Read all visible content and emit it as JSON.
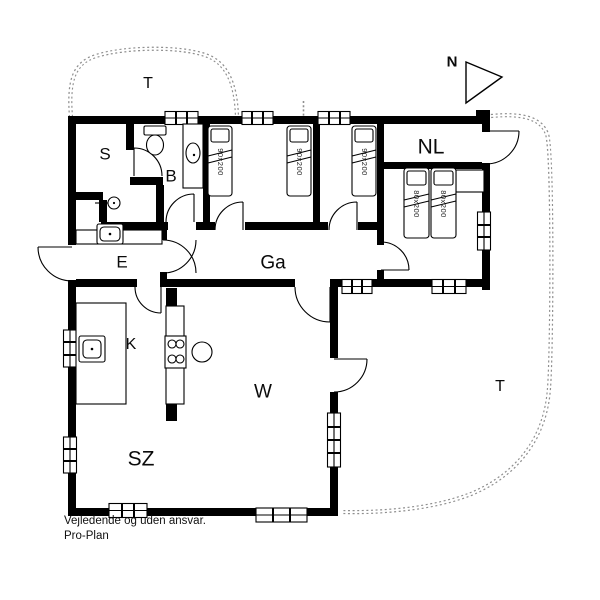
{
  "plan": {
    "rooms": [
      {
        "id": "terrace-top",
        "label": "T"
      },
      {
        "id": "s-room",
        "label": "S"
      },
      {
        "id": "bathroom",
        "label": "B"
      },
      {
        "id": "nl-room",
        "label": "NL"
      },
      {
        "id": "entrance",
        "label": "E"
      },
      {
        "id": "hallway",
        "label": "Ga"
      },
      {
        "id": "kitchen",
        "label": "K"
      },
      {
        "id": "w-room",
        "label": "W"
      },
      {
        "id": "living-room",
        "label": "SZ"
      },
      {
        "id": "terrace-right",
        "label": "T"
      }
    ],
    "beds": [
      {
        "id": "single-bed-1",
        "size": "90x200"
      },
      {
        "id": "single-bed-2",
        "size": "90x200"
      },
      {
        "id": "single-bed-3",
        "size": "90x200"
      },
      {
        "id": "double-bed-left",
        "size": "80x200"
      },
      {
        "id": "double-bed-right",
        "size": "80x200"
      }
    ],
    "north_label": "N"
  },
  "footer": {
    "disclaimer": "Vejledende og uden ansvar.",
    "brand": "Pro-Plan"
  },
  "colors": {
    "wall": "#000000",
    "terrace_outline": "#8f8f8f",
    "background": "#ffffff"
  }
}
